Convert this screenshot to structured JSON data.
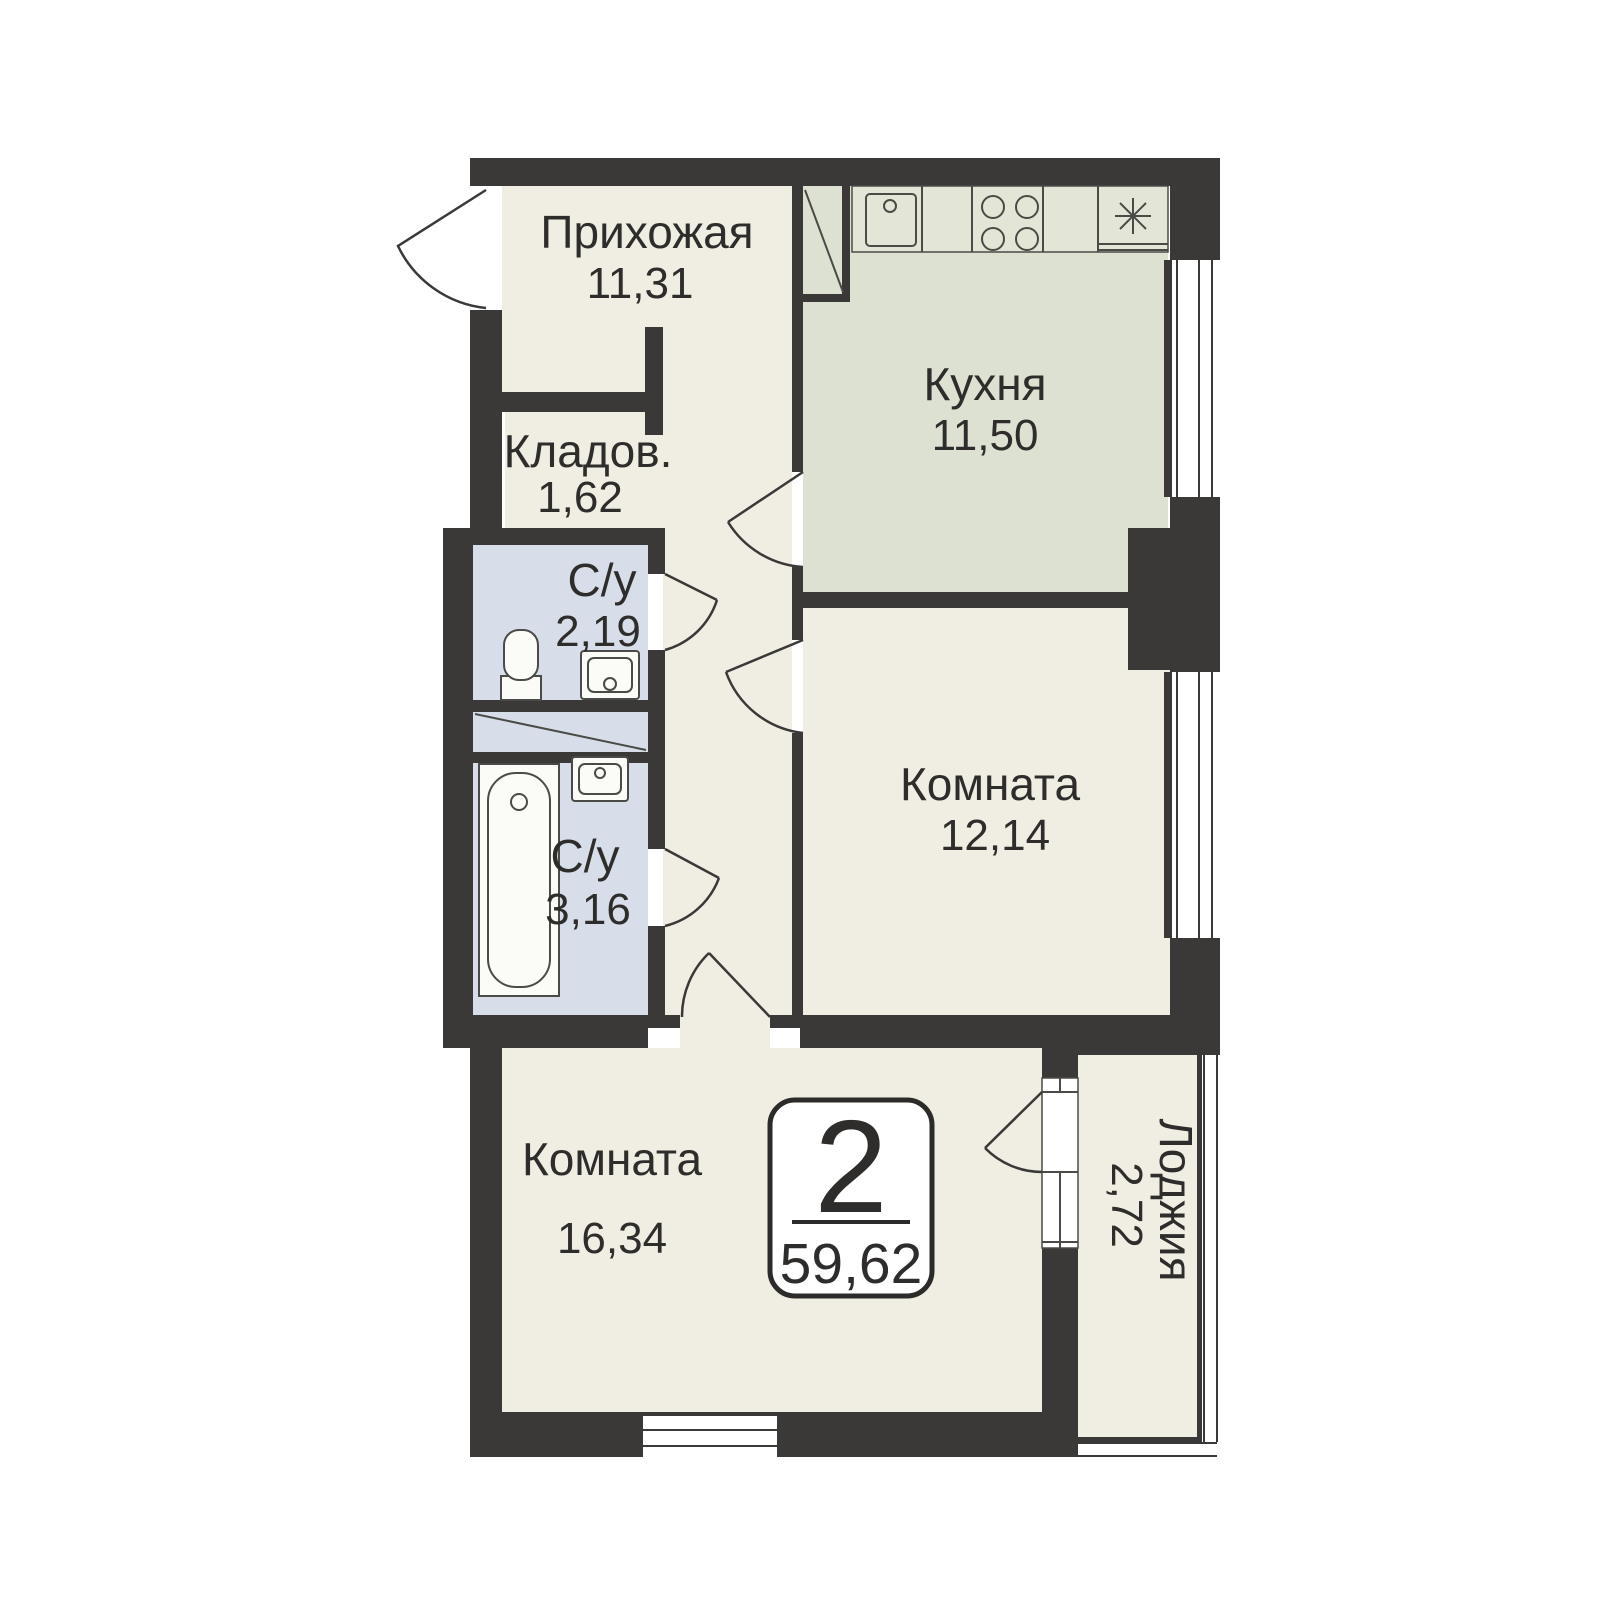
{
  "plan_type": "apartment-floor-plan",
  "rooms": {
    "hallway": {
      "name": "Прихожая",
      "area": "11,31"
    },
    "kitchen": {
      "name": "Кухня",
      "area": "11,50"
    },
    "storage": {
      "name": "Кладов.",
      "area": "1,62"
    },
    "bath_small": {
      "name": "С/у",
      "area": "2,19"
    },
    "bath_large": {
      "name": "С/у",
      "area": "3,16"
    },
    "bedroom": {
      "name": "Комната",
      "area": "12,14"
    },
    "living": {
      "name": "Комната",
      "area": "16,34"
    },
    "loggia": {
      "name": "Лоджия",
      "area": "2,72"
    }
  },
  "badge": {
    "rooms_count": "2",
    "total_area": "59,62"
  },
  "icons": {
    "toilet": "toilet-icon",
    "sink_small": "sink-icon",
    "bathtub": "bathtub-icon",
    "sink_large": "sink-icon",
    "kitchen_sink": "kitchen-sink-icon",
    "stove": "stove-icon",
    "fridge": "fridge-icon",
    "vent_shaft": "vent-shaft-icon",
    "door_swing": "door-swing-icon",
    "window": "window-icon"
  },
  "theme": {
    "background": "#ffffff",
    "wall": "#3a3938",
    "floor_main": "#f0ede2",
    "floor_kitchen": "#dde1d2",
    "floor_bath": "#d7deea",
    "counter_fill": "#e3e6d7",
    "fixture_fill": "#fbfbf8",
    "line": "#4a4a46",
    "badge_stroke": "#2c2b2a",
    "text": "#2e2d2b"
  }
}
